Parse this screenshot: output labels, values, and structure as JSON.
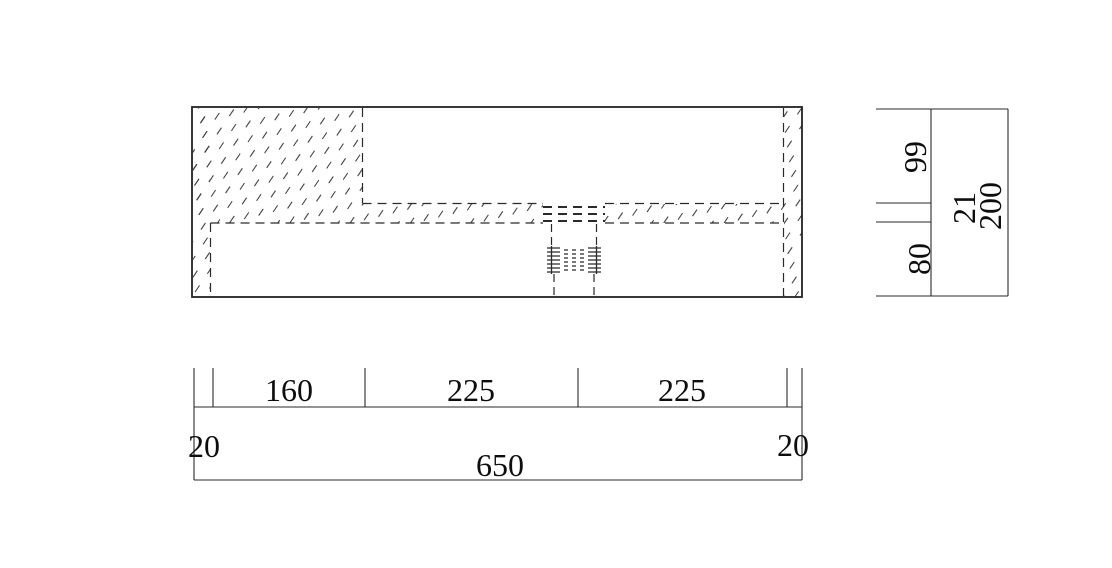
{
  "dimensions": {
    "horizontal": {
      "segments": [
        "160",
        "225",
        "225"
      ],
      "edge_left": "20",
      "edge_right": "20",
      "overall": "650"
    },
    "vertical": {
      "upper": "99",
      "ledge_thickness": "21",
      "lower": "80",
      "overall": "200"
    }
  },
  "colors": {
    "line": "#2a2a2a",
    "text": "#0d0d0d",
    "hatch": "#3c3c3c",
    "background": "#ffffff"
  }
}
